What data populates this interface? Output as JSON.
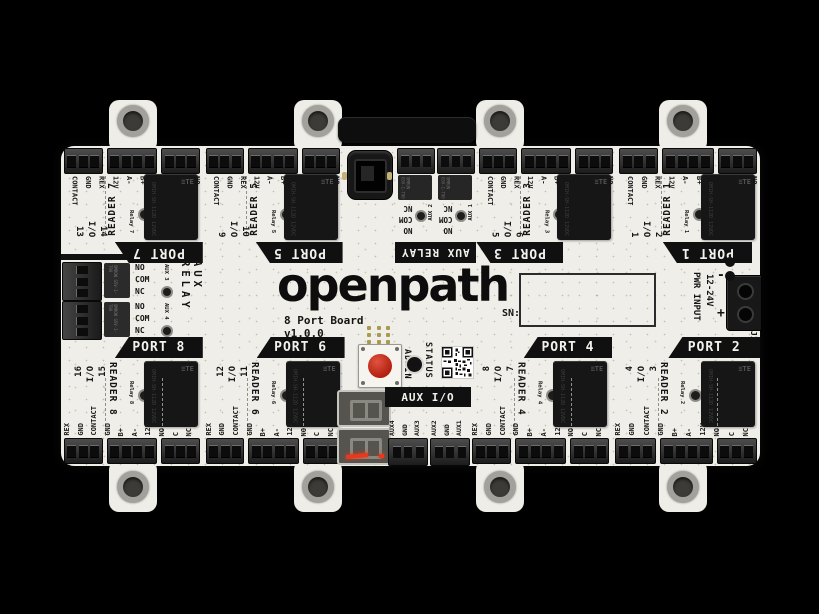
{
  "brand": "openpath",
  "board_title": "8 Port Board",
  "board_version": "v1.0.0",
  "sn_label": "SN:",
  "io_label": "I/O",
  "relay_brand": "≡TE",
  "relay_part": "OMIH-SH-112D 12VDC",
  "admin_label": "ADMIN",
  "status_label": "STATUS",
  "power": {
    "label": "PWR INPUT",
    "voltage": "12-24V",
    "negative": "-",
    "positive": "+",
    "designator": "J1"
  },
  "aux_relay_top": {
    "label": "AUX RELAY",
    "relay_text": "OMRON G5V-1-T90",
    "channels": [
      {
        "name": "AUX 2",
        "pins": [
          "NC",
          "COM",
          "NO"
        ]
      },
      {
        "name": "AUX 1",
        "pins": [
          "NC",
          "COM",
          "NO"
        ]
      }
    ]
  },
  "aux_relay_left": {
    "label": "AUX RELAY",
    "relay_text": "OMRON G5V-1-T90",
    "channels": [
      {
        "name": "AUX 3",
        "pins": [
          "NO",
          "COM",
          "NC"
        ]
      },
      {
        "name": "AUX 4",
        "pins": [
          "NO",
          "COM",
          "NC"
        ]
      }
    ]
  },
  "aux_io": {
    "label": "AUX I/O",
    "groups": [
      {
        "pins": [
          "AUX4",
          "GND",
          "AUX3"
        ]
      },
      {
        "pins": [
          "AUX2",
          "GND",
          "AUX1"
        ]
      }
    ]
  },
  "ports_top": [
    {
      "name": "PORT 7",
      "reader": "READER 7",
      "relay": "Relay 7",
      "io_left": "13",
      "io_right": "14",
      "pins_a": [
        "CONTACT",
        "GND",
        "REX"
      ],
      "pins_b": [
        "12V",
        "A-",
        "B+",
        "GND"
      ],
      "pins_c": [
        "NC",
        "C",
        "NO"
      ]
    },
    {
      "name": "PORT 5",
      "reader": "READER 5",
      "relay": "Relay 5",
      "io_left": "9",
      "io_right": "10",
      "pins_a": [
        "CONTACT",
        "GND",
        "REX"
      ],
      "pins_b": [
        "12V",
        "A-",
        "B+",
        "GND"
      ],
      "pins_c": [
        "NC",
        "C",
        "NO"
      ]
    },
    {
      "name": "PORT 3",
      "reader": "READER 3",
      "relay": "Relay 3",
      "io_left": "5",
      "io_right": "6",
      "pins_a": [
        "CONTACT",
        "GND",
        "REX"
      ],
      "pins_b": [
        "12V",
        "A-",
        "B+",
        "GND"
      ],
      "pins_c": [
        "NC",
        "C",
        "NO"
      ]
    },
    {
      "name": "PORT 1",
      "reader": "READER 1",
      "relay": "Relay 1",
      "io_left": "1",
      "io_right": "2",
      "pins_a": [
        "CONTACT",
        "GND",
        "REX"
      ],
      "pins_b": [
        "12V",
        "A-",
        "B+",
        "GND"
      ],
      "pins_c": [
        "NC",
        "C",
        "NO"
      ]
    }
  ],
  "ports_bottom": [
    {
      "name": "PORT 8",
      "reader": "READER 8",
      "relay": "Relay 8",
      "io_left": "16",
      "io_right": "15",
      "pins_a": [
        "REX",
        "GND",
        "CONTACT"
      ],
      "pins_b": [
        "GND",
        "B+",
        "A-",
        "12V"
      ],
      "pins_c": [
        "NO",
        "C",
        "NC"
      ]
    },
    {
      "name": "PORT 6",
      "reader": "READER 6",
      "relay": "Relay 6",
      "io_left": "12",
      "io_right": "11",
      "pins_a": [
        "REX",
        "GND",
        "CONTACT"
      ],
      "pins_b": [
        "GND",
        "B+",
        "A-",
        "12V"
      ],
      "pins_c": [
        "NO",
        "C",
        "NC"
      ]
    },
    {
      "name": "PORT 4",
      "reader": "READER 4",
      "relay": "Relay 4",
      "io_left": "8",
      "io_right": "7",
      "pins_a": [
        "REX",
        "GND",
        "CONTACT"
      ],
      "pins_b": [
        "GND",
        "B+",
        "A-",
        "12V"
      ],
      "pins_c": [
        "NO",
        "C",
        "NC"
      ]
    },
    {
      "name": "PORT 2",
      "reader": "READER 2",
      "relay": "Relay 2",
      "io_left": "4",
      "io_right": "3",
      "pins_a": [
        "REX",
        "GND",
        "CONTACT"
      ],
      "pins_b": [
        "GND",
        "B+",
        "A-",
        "12V"
      ],
      "pins_c": [
        "NO",
        "C",
        "NC"
      ]
    }
  ],
  "colors": {
    "background": "#000000",
    "board": "#f0eee8",
    "silkscreen": "#141414",
    "banner": "#101010",
    "admin_button": "#b3200f",
    "lit_segment": "#e8391c",
    "gold_pad": "#a99a50"
  }
}
